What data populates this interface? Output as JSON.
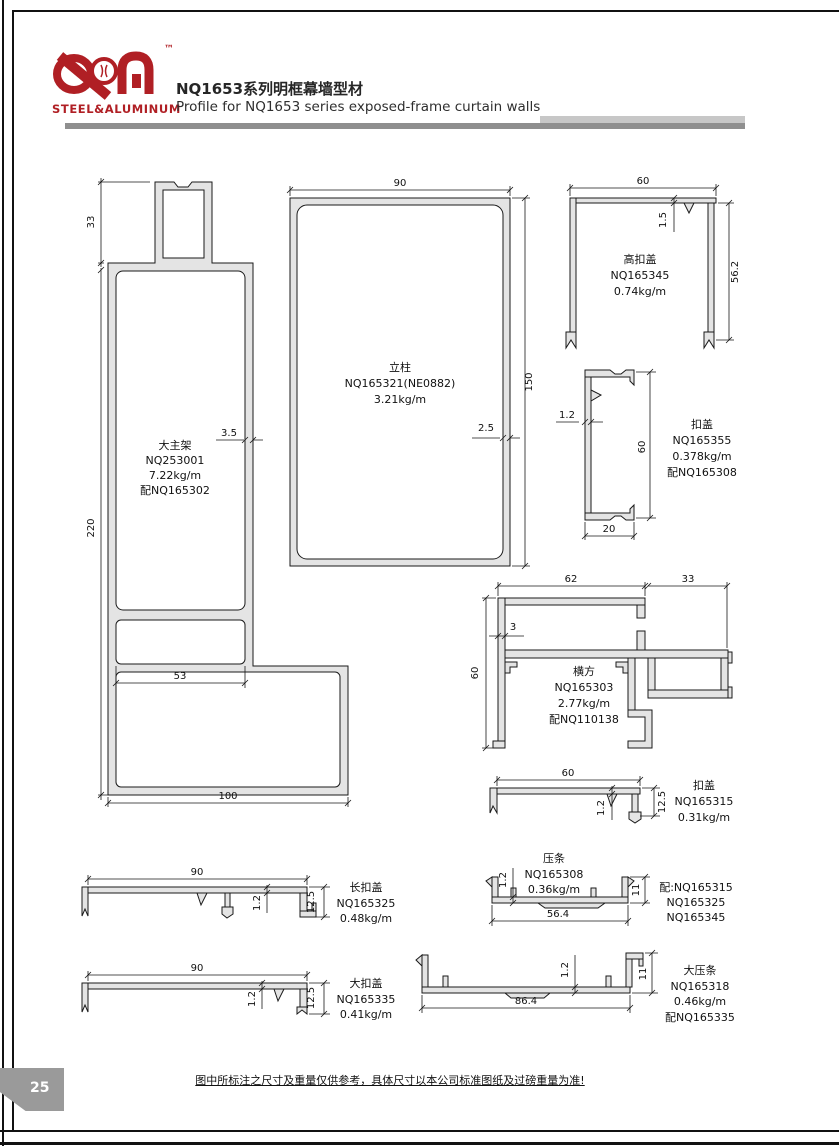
{
  "header": {
    "logo": {
      "tm": "™",
      "subtitle": "STEEL&ALUMINUM",
      "brand_color": "#b01f24"
    },
    "title_zh": "NQ1653系列明框幕墙型材",
    "title_en": "Profile for NQ1653 series exposed-frame curtain walls"
  },
  "profiles": {
    "p1": {
      "name": "大主架",
      "code": "NQ253001",
      "weight": "7.22kg/m",
      "match": "配NQ165302",
      "d_top": "33",
      "d_height": "220",
      "d_wall": "3.5",
      "d_inner": "53",
      "d_width": "100"
    },
    "p2": {
      "name": "立柱",
      "code": "NQ165321(NE0882)",
      "weight": "3.21kg/m",
      "d_width": "90",
      "d_height": "150",
      "d_wall": "2.5"
    },
    "p3": {
      "name": "高扣盖",
      "code": "NQ165345",
      "weight": "0.74kg/m",
      "d_width": "60",
      "d_wall": "1.5",
      "d_height": "56.2"
    },
    "p4": {
      "name": "扣盖",
      "code": "NQ165355",
      "weight": "0.378kg/m",
      "match": "配NQ165308",
      "d_wall": "1.2",
      "d_height": "60",
      "d_width": "20"
    },
    "p5": {
      "name": "横方",
      "code": "NQ165303",
      "weight": "2.77kg/m",
      "match": "配NQ110138",
      "d_w_left": "62",
      "d_w_right": "33",
      "d_wall": "3",
      "d_height": "60"
    },
    "p6": {
      "name": "扣盖",
      "code": "NQ165315",
      "weight": "0.31kg/m",
      "d_width": "60",
      "d_wall": "1.2",
      "d_height": "12.5"
    },
    "p7": {
      "name": "压条",
      "code": "NQ165308",
      "weight": "0.36kg/m",
      "match1": "配:NQ165315",
      "match2": "NQ165325",
      "match3": "NQ165345",
      "d_wall": "1.2",
      "d_height": "11",
      "d_width": "56.4"
    },
    "p8": {
      "name": "长扣盖",
      "code": "NQ165325",
      "weight": "0.48kg/m",
      "d_width": "90",
      "d_wall": "1.2",
      "d_height": "12.5"
    },
    "p9": {
      "name": "大扣盖",
      "code": "NQ165335",
      "weight": "0.41kg/m",
      "d_width": "90",
      "d_wall": "1.2",
      "d_height": "12.5"
    },
    "p10": {
      "name": "大压条",
      "code": "NQ165318",
      "weight": "0.46kg/m",
      "match": "配NQ165335",
      "d_wall": "1.2",
      "d_height": "11",
      "d_width": "86.4"
    }
  },
  "footer": {
    "page_number": "25",
    "note": "图中所标注之尺寸及重量仅供参考，具体尺寸以本公司标准图纸及过磅重量为准!"
  }
}
